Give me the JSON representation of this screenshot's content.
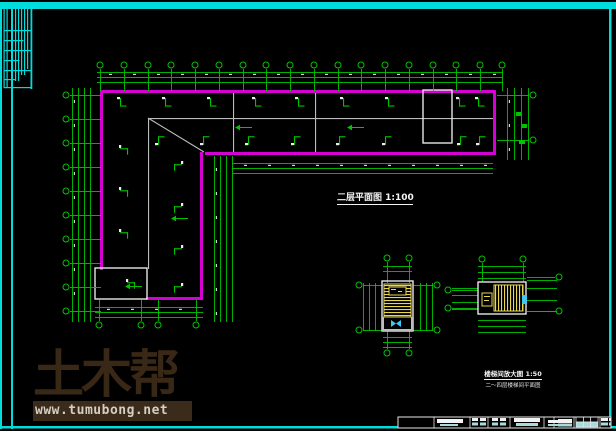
{
  "colors": {
    "background": "#000000",
    "frame_cyan": "#00dcdc",
    "wall_magenta": "#d400d4",
    "dim_green": "#00c400",
    "partition_gray": "#bdbdbd",
    "outline_white": "#e6e6e6",
    "stair_yellow": "#e8d84e",
    "detail_cyan": "#40c8f0",
    "tick_white": "#ececec",
    "titleblock_cyan": "#a8dcdc"
  },
  "labels": {
    "main_plan": {
      "text": "二层平面图 1:100"
    },
    "stair_detail": {
      "line1": "楼梯间放大图 1:50",
      "line2": "二～四层楼梯间平面图"
    }
  },
  "watermark": {
    "brand": "土木帮",
    "url": "www.tumubong.net"
  },
  "geometry": {
    "frame": {
      "bars": [
        [
          0,
          2,
          616,
          7
        ],
        [
          0,
          2,
          2,
          427
        ],
        [
          11,
          9,
          2,
          420
        ],
        [
          609,
          9,
          2.5,
          418
        ],
        [
          0,
          426,
          616,
          2.5
        ]
      ],
      "cluster": [
        [
          3.5,
          9,
          1.2,
          78
        ],
        [
          6.5,
          9,
          1.2,
          78
        ],
        [
          15,
          9,
          1.2,
          72
        ],
        [
          18,
          9,
          1.2,
          72
        ],
        [
          21,
          9,
          1.2,
          66
        ],
        [
          24,
          9,
          1.2,
          66
        ],
        [
          27,
          9,
          1.2,
          60
        ],
        [
          30.5,
          9,
          1.8,
          80
        ],
        [
          3.5,
          30,
          27,
          1.2
        ],
        [
          3.5,
          40,
          20,
          1.2
        ],
        [
          3.5,
          50,
          27,
          1.2
        ],
        [
          3.5,
          60,
          16,
          1.2
        ],
        [
          3.5,
          70,
          27,
          1.2
        ],
        [
          3.5,
          79,
          12,
          1.2
        ],
        [
          3.5,
          87,
          28,
          1.2
        ]
      ]
    },
    "walls": [
      [
        100,
        90,
        396,
        3
      ],
      [
        493,
        90,
        3,
        65
      ],
      [
        205,
        152,
        291,
        3
      ],
      [
        200,
        152,
        3,
        148
      ],
      [
        100,
        90,
        3,
        180
      ],
      [
        146,
        297,
        57,
        3
      ]
    ],
    "gray_lines": [
      [
        148,
        118,
        345,
        1.1
      ],
      [
        233,
        93,
        1.1,
        59
      ],
      [
        315,
        93,
        1.1,
        59
      ],
      [
        148,
        119,
        1.1,
        150
      ]
    ],
    "outlines": [
      [
        423,
        90,
        29,
        53
      ],
      [
        95,
        268,
        52,
        31
      ]
    ],
    "diagonals": [
      [
        148,
        118,
        204,
        152
      ]
    ],
    "dims": [
      {
        "o": "h",
        "x1": 97,
        "x2": 503,
        "ys": [
          72,
          77,
          82
        ],
        "t": 1
      },
      {
        "o": "v",
        "y1": 88,
        "y2": 322,
        "xs": [
          72,
          78,
          84,
          90
        ],
        "t": 1
      },
      {
        "o": "v",
        "y1": 156,
        "y2": 322,
        "xs": [
          214,
          220,
          226,
          232
        ],
        "t": 1
      },
      {
        "o": "h",
        "x1": 232,
        "x2": 493,
        "ys": [
          163,
          168,
          173
        ],
        "t": 1
      },
      {
        "o": "v",
        "y1": 88,
        "y2": 160,
        "xs": [
          507,
          514,
          521,
          528
        ],
        "t": 1
      },
      {
        "o": "h",
        "x1": 95,
        "x2": 203,
        "ys": [
          307,
          312,
          317
        ],
        "t": 1
      },
      {
        "o": "h",
        "x1": 383,
        "x2": 412,
        "ys": [
          266,
          271
        ]
      },
      {
        "o": "v",
        "y1": 283,
        "y2": 331,
        "xs": [
          363,
          369,
          375
        ]
      },
      {
        "o": "v",
        "y1": 283,
        "y2": 331,
        "xs": [
          420,
          426,
          432
        ]
      },
      {
        "o": "h",
        "x1": 383,
        "x2": 412,
        "ys": [
          337,
          342,
          347
        ]
      },
      {
        "o": "h",
        "x1": 478,
        "x2": 526,
        "ys": [
          266,
          272,
          278
        ]
      },
      {
        "o": "h",
        "x1": 478,
        "x2": 526,
        "ys": [
          320,
          326,
          332
        ]
      },
      {
        "o": "h",
        "x1": 452,
        "x2": 478,
        "ys": [
          288,
          295,
          302,
          309
        ]
      },
      {
        "o": "h",
        "x1": 527,
        "x2": 557,
        "ys": [
          280,
          288,
          300,
          311
        ]
      }
    ],
    "bubble_groups": [
      {
        "o": "col",
        "y": 65,
        "xs": [
          100,
          124,
          148,
          171,
          195,
          219,
          243,
          266,
          290,
          314,
          338,
          361,
          385,
          409,
          433,
          456,
          480,
          502
        ],
        "stem": [
          69,
          91
        ]
      },
      {
        "o": "row",
        "x": 66,
        "ys": [
          95,
          119,
          143,
          167,
          191,
          215,
          239,
          263,
          287,
          311
        ],
        "stem": [
          70,
          101
        ]
      },
      {
        "o": "col",
        "y": 325,
        "xs": [
          99,
          141,
          158,
          196
        ],
        "stem": [
          300,
          321
        ]
      },
      {
        "o": "row",
        "x": 533,
        "ys": [
          95,
          140
        ],
        "stem": [
          497,
          529
        ]
      },
      {
        "o": "col",
        "y": 258,
        "xs": [
          387,
          409
        ],
        "stem": [
          262,
          283
        ]
      },
      {
        "o": "col",
        "y": 353,
        "xs": [
          387,
          409
        ],
        "stem": [
          331,
          349
        ]
      },
      {
        "o": "row",
        "x": 359,
        "ys": [
          285,
          330
        ],
        "stem": [
          363,
          383
        ]
      },
      {
        "o": "row",
        "x": 437,
        "ys": [
          285,
          330
        ],
        "stem": [
          413,
          433
        ]
      },
      {
        "o": "col",
        "y": 259,
        "xs": [
          482,
          523
        ],
        "stem": [
          263,
          282
        ]
      },
      {
        "o": "row",
        "x": 448,
        "ys": [
          290,
          308
        ],
        "stem": [
          452,
          478
        ]
      },
      {
        "o": "row",
        "x": 559,
        "ys": [
          277,
          311
        ],
        "stem": [
          527,
          555
        ]
      }
    ],
    "doors": [
      [
        122,
        98,
        "d"
      ],
      [
        167,
        98,
        "d"
      ],
      [
        212,
        98,
        "d"
      ],
      [
        257,
        98,
        "d"
      ],
      [
        300,
        98,
        "d"
      ],
      [
        345,
        98,
        "d"
      ],
      [
        390,
        98,
        "d"
      ],
      [
        461,
        98,
        "d"
      ],
      [
        480,
        98,
        "d"
      ],
      [
        160,
        139,
        "u"
      ],
      [
        205,
        139,
        "u"
      ],
      [
        250,
        139,
        "u"
      ],
      [
        296,
        139,
        "u"
      ],
      [
        341,
        139,
        "u"
      ],
      [
        387,
        139,
        "u"
      ],
      [
        462,
        139,
        "u"
      ],
      [
        481,
        139,
        "u"
      ],
      [
        120,
        150,
        "r"
      ],
      [
        120,
        192,
        "r"
      ],
      [
        120,
        234,
        "r"
      ],
      [
        127,
        284,
        "r"
      ],
      [
        182,
        166,
        "l"
      ],
      [
        182,
        208,
        "l"
      ],
      [
        182,
        250,
        "l"
      ],
      [
        182,
        288,
        "l"
      ]
    ],
    "arrows": [
      [
        240,
        127
      ],
      [
        352,
        127
      ],
      [
        176,
        218
      ],
      [
        130,
        286
      ]
    ],
    "green_squares": [
      [
        516,
        112,
        5,
        4
      ],
      [
        522,
        124,
        5,
        4
      ],
      [
        519,
        140,
        6,
        4
      ]
    ],
    "detail1": {
      "outline": [
        382,
        281,
        31,
        50
      ],
      "lower": [
        [
          382,
          317,
          2,
          14
        ],
        [
          411,
          317,
          2,
          14
        ],
        [
          382,
          329,
          31,
          2
        ]
      ],
      "hatch": [
        384,
        284,
        27,
        33
      ],
      "tag": [
        389,
        287,
        17,
        8
      ],
      "bowtie": [
        [
          [
            391,
            320
          ],
          [
            391,
            327
          ],
          [
            396,
            323.5
          ]
        ],
        [
          [
            401,
            320
          ],
          [
            401,
            327
          ],
          [
            396,
            323.5
          ]
        ]
      ]
    },
    "detail2": {
      "outline": [
        478,
        282,
        48,
        32
      ],
      "hatch": [
        494,
        285,
        29,
        26
      ],
      "tag": [
        482,
        293,
        10,
        13
      ],
      "cyan_rect": [
        522,
        295,
        5,
        9
      ]
    },
    "title_block": {
      "outer": [
        398,
        417,
        213,
        11
      ],
      "dividers": [
        434,
        470,
        488,
        510,
        544,
        554,
        574,
        600
      ],
      "white_bars": [
        [
          437,
          419,
          26,
          4
        ],
        [
          472,
          418,
          6,
          3
        ],
        [
          480,
          418,
          6,
          3
        ],
        [
          492,
          418,
          6,
          3
        ],
        [
          500,
          418,
          6,
          3
        ],
        [
          514,
          418,
          26,
          4
        ],
        [
          548,
          420,
          10,
          3
        ],
        [
          558,
          419,
          14,
          4
        ],
        [
          601,
          418,
          7,
          3
        ],
        [
          609,
          418,
          2,
          3
        ]
      ],
      "cyan_bars": [
        [
          440,
          424,
          18,
          2
        ],
        [
          472,
          422.5,
          6,
          3
        ],
        [
          480,
          422.5,
          6,
          3
        ],
        [
          492,
          422.5,
          6,
          3
        ],
        [
          500,
          422.5,
          6,
          3
        ],
        [
          516,
          423,
          22,
          3
        ],
        [
          548,
          424,
          10,
          2
        ],
        [
          558,
          423.5,
          14,
          3
        ],
        [
          601,
          422.5,
          7,
          3
        ],
        [
          609,
          422.5,
          2,
          3
        ]
      ],
      "grid": {
        "x": 576,
        "y": 417,
        "w": 22,
        "h": 10,
        "cols": 3,
        "rows": 2
      }
    }
  }
}
